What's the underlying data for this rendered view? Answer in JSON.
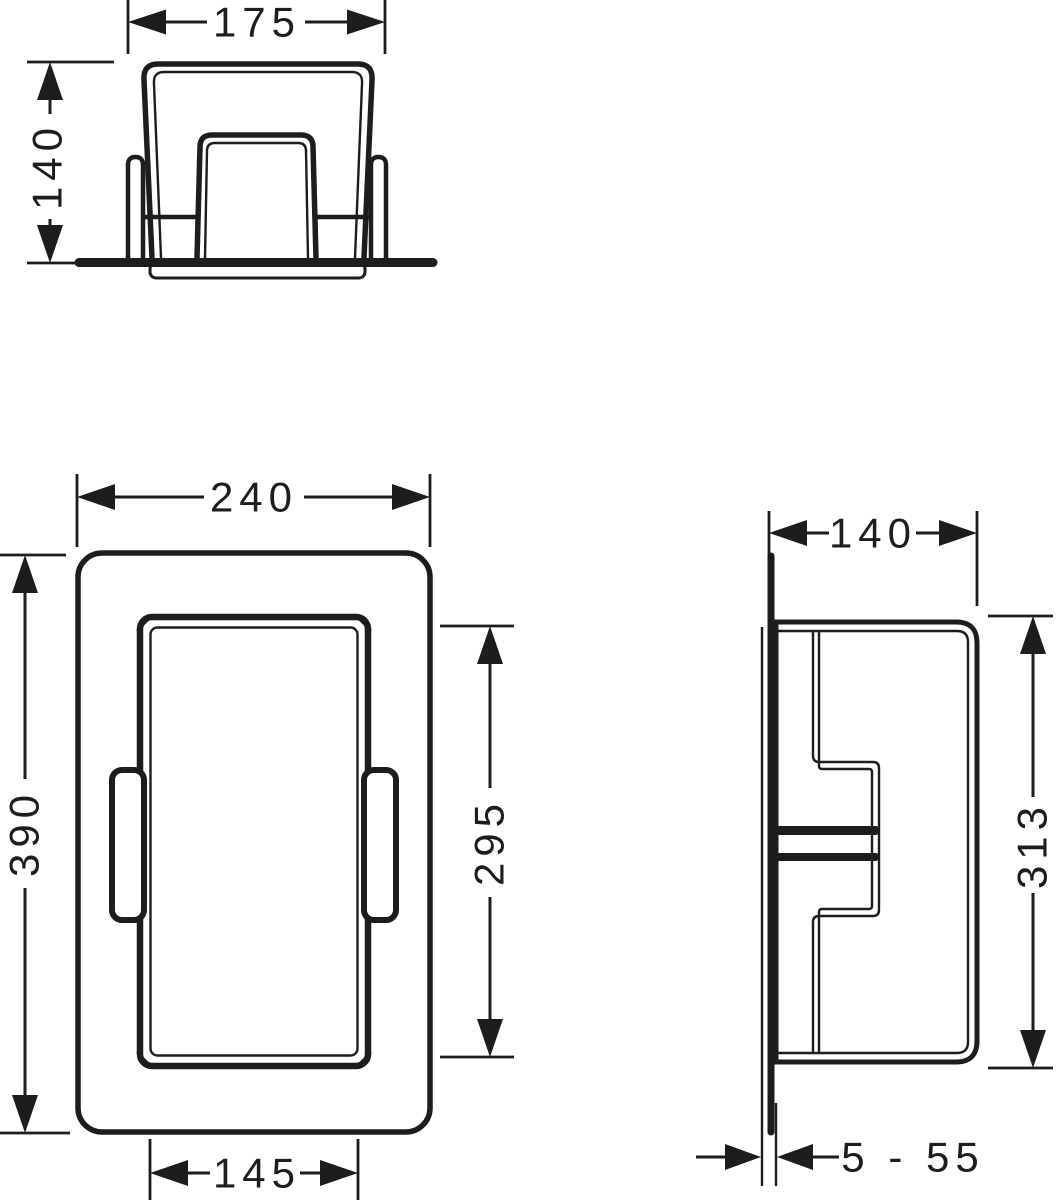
{
  "drawing": {
    "type": "technical-dimension-drawing",
    "background": "#ffffff",
    "ink": "#1d1d1b",
    "views": {
      "top": {
        "title": "top-view",
        "width": "175",
        "depth": "140"
      },
      "front": {
        "title": "front-view",
        "width": "240",
        "height": "390",
        "opening_height": "295",
        "opening_width": "145"
      },
      "side": {
        "title": "side-view",
        "depth": "140",
        "height": "313",
        "tile_range": "5 - 55"
      }
    }
  }
}
